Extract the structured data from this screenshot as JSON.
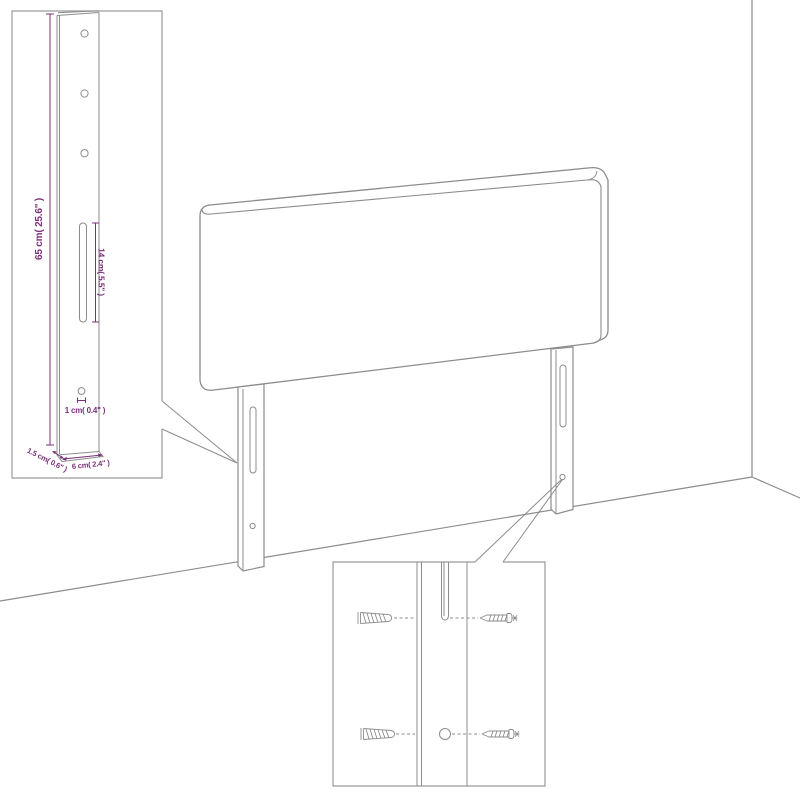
{
  "diagram": {
    "subject": "headboard-assembly-diagram",
    "colors": {
      "line_gray": "#8c8c8c",
      "inset_border_gray": "#9a9a9a",
      "dimension_purple": "#7b3179",
      "background": "#ffffff"
    },
    "leg_detail_inset": {
      "labels": {
        "leg_height": "65 cm( 25.6\" )",
        "slot_length": "14 cm( 5.5\" )",
        "hole_size": "1 cm( 0.4\" )",
        "leg_depth": "1.5 cm( 0.6\" )",
        "leg_width": "6 cm( 2.4\" )"
      }
    },
    "mounting_detail_inset": {
      "icons": [
        "wall-plug-icon",
        "screw-icon"
      ]
    }
  }
}
